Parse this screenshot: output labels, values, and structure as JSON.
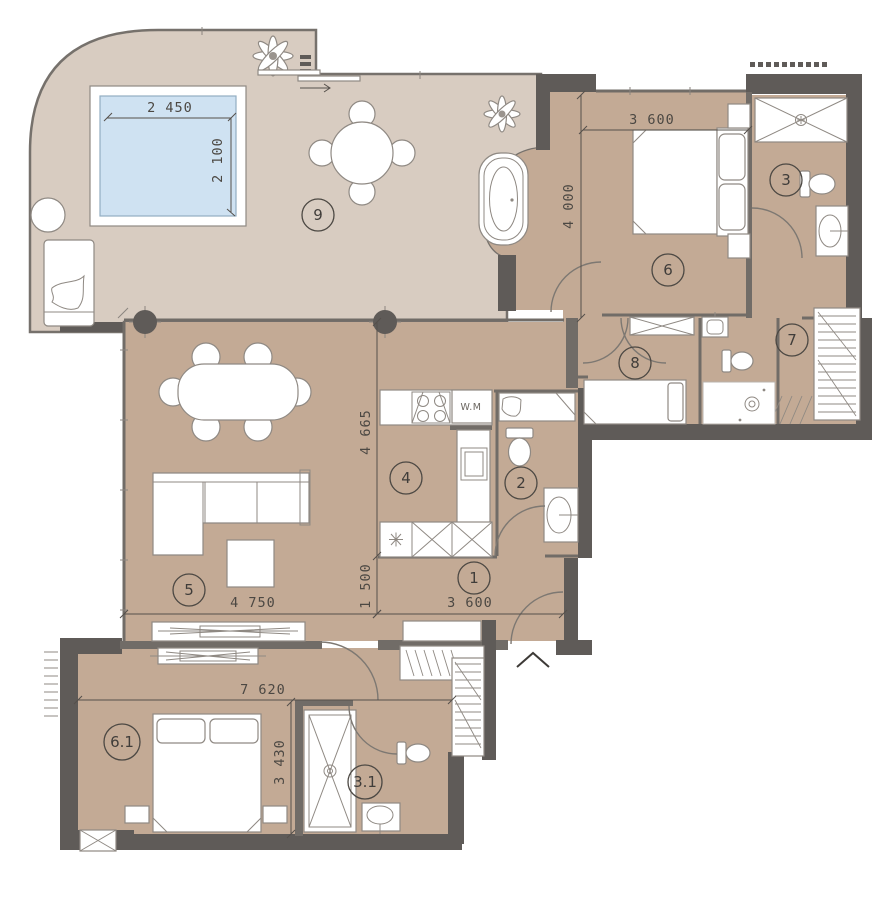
{
  "plan": {
    "type": "apartment-floor-plan",
    "rooms": [
      {
        "id": "terrace",
        "label": "9"
      },
      {
        "id": "bedroom-master",
        "label": "6"
      },
      {
        "id": "bathroom-master",
        "label": "3"
      },
      {
        "id": "walk-in-closet",
        "label": "7"
      },
      {
        "id": "bedroom-small",
        "label": "8"
      },
      {
        "id": "kitchen",
        "label": "4"
      },
      {
        "id": "bathroom-guest",
        "label": "2"
      },
      {
        "id": "hallway",
        "label": "1"
      },
      {
        "id": "living-room",
        "label": "5"
      },
      {
        "id": "bedroom-second",
        "label": "6.1"
      },
      {
        "id": "bathroom-second",
        "label": "3.1"
      }
    ],
    "dimensions": [
      {
        "id": "pool-width",
        "text": "2 450"
      },
      {
        "id": "pool-depth",
        "text": "2 100"
      },
      {
        "id": "bedroom-master-width",
        "text": "3 600"
      },
      {
        "id": "bedroom-master-depth",
        "text": "4 000"
      },
      {
        "id": "kitchen-zone-depth",
        "text": "4 665"
      },
      {
        "id": "hall-zone-depth",
        "text": "1 500"
      },
      {
        "id": "living-width",
        "text": "4 750"
      },
      {
        "id": "hallway-width",
        "text": "3 600"
      },
      {
        "id": "lower-unit-width",
        "text": "7 620"
      },
      {
        "id": "lower-unit-depth",
        "text": "3 430"
      }
    ],
    "appliances": {
      "washing_machine": "W.M"
    },
    "colors": {
      "wall": "#5f5b58",
      "floor_room": "#c3aa95",
      "floor_terrace": "#d8ccc1",
      "pool_water": "#cfe2f2",
      "line": "#8b857f",
      "dim_text": "#4c4843"
    }
  }
}
